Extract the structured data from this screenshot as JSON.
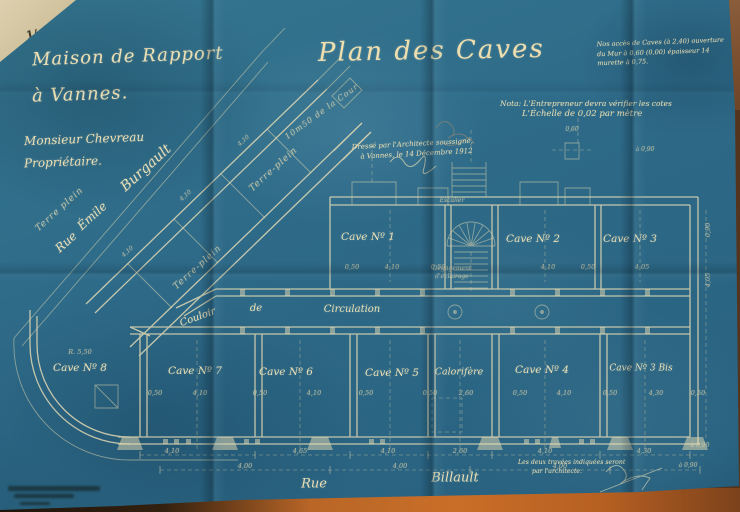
{
  "palette": {
    "paper_blue": "#2e6b89",
    "ink_cream": "#eadfb5",
    "table_orange": "#c96e28",
    "table_cream": "#ddd0ae",
    "table_brown": "#6e4527"
  },
  "header": {
    "corner_mark": "1/",
    "line1": "Maison de Rapport",
    "line2": "à Vannes.",
    "line3": "Monsieur Chevreau",
    "line4": "Propriétaire.",
    "title": "Plan des Caves"
  },
  "notes": {
    "top_right": [
      "Nos accès de Caves (à 2,40) ouverture",
      "du Mur à 0,60 (0,00) épaisseur 14",
      "murette à 0,75."
    ],
    "nota_line1": "Nota: L'Entrepreneur devra vérifier les cotes",
    "nota_line2": "L'Échelle de 0,02 par mètre",
    "architect_line1": "Dressé par l'Architecte soussigné,",
    "architect_line2": "à Vannes, le 14 Décembre 1912",
    "bottom_line1": "Les deux travées indiquées seront",
    "bottom_line2": "par l'architecte."
  },
  "labels": [
    {
      "n": "room-label-cave-1",
      "t": "Cave Nº 1",
      "x": 368,
      "y": 237,
      "s": 10.5
    },
    {
      "n": "room-label-cave-2",
      "t": "Cave Nº 2",
      "x": 533,
      "y": 239,
      "s": 10.5
    },
    {
      "n": "room-label-cave-3",
      "t": "Cave Nº 3",
      "x": 630,
      "y": 239,
      "s": 10.5
    },
    {
      "n": "room-label-cave-8",
      "t": "Cave Nº 8",
      "x": 80,
      "y": 368,
      "s": 10.5
    },
    {
      "n": "room-label-cave-7",
      "t": "Cave Nº 7",
      "x": 195,
      "y": 371,
      "s": 10.5
    },
    {
      "n": "room-label-cave-6",
      "t": "Cave Nº 6",
      "x": 286,
      "y": 372,
      "s": 10.5
    },
    {
      "n": "room-label-cave-5",
      "t": "Cave Nº 5",
      "x": 392,
      "y": 373,
      "s": 10.5
    },
    {
      "n": "room-label-calorifere",
      "t": "Calorifère",
      "x": 459,
      "y": 372,
      "s": 9.5
    },
    {
      "n": "room-label-cave-4",
      "t": "Cave Nº 4",
      "x": 542,
      "y": 370,
      "s": 10.5
    },
    {
      "n": "room-label-cave-3bis",
      "t": "Cave Nº 3 Bis",
      "x": 641,
      "y": 369,
      "s": 9
    },
    {
      "n": "corridor-label-couloir",
      "t": "Couloir",
      "x": 198,
      "y": 318,
      "s": 10,
      "r": -20
    },
    {
      "n": "corridor-label-de",
      "t": "de",
      "x": 256,
      "y": 309,
      "s": 10
    },
    {
      "n": "corridor-label-circulation",
      "t": "Circulation",
      "x": 352,
      "y": 310,
      "s": 10
    },
    {
      "n": "stair-label-degagement",
      "t": "Dégagement",
      "x": 452,
      "y": 269,
      "s": 6,
      "c": "dim"
    },
    {
      "n": "stair-label-eclairage",
      "t": "d'éclairage",
      "x": 452,
      "y": 277,
      "s": 6,
      "c": "dim"
    },
    {
      "n": "stair-label-escalier",
      "t": "Escalier",
      "x": 452,
      "y": 201,
      "s": 6,
      "c": "dim"
    },
    {
      "n": "street-rue-emile-rue",
      "t": "Rue",
      "x": 66,
      "y": 242,
      "s": 12,
      "r": -42
    },
    {
      "n": "street-rue-emile-emile",
      "t": "Émile",
      "x": 92,
      "y": 216,
      "s": 12,
      "r": -42
    },
    {
      "n": "street-rue-emile-burgault",
      "t": "Burgault",
      "x": 146,
      "y": 168,
      "s": 14,
      "r": -42
    },
    {
      "n": "terre-plein-left",
      "t": "Terre plein",
      "x": 60,
      "y": 210,
      "s": 9,
      "r": -42,
      "c": "dim2"
    },
    {
      "n": "terre-plein-mid",
      "t": "Terre-plein",
      "x": 274,
      "y": 170,
      "s": 9,
      "r": -42,
      "c": "dim2"
    },
    {
      "n": "terre-plein-low",
      "t": "Terre-plein",
      "x": 198,
      "y": 268,
      "s": 9,
      "r": -42,
      "c": "dim2"
    },
    {
      "n": "cour-note",
      "t": "10m50 de la Cour",
      "x": 322,
      "y": 112,
      "s": 8,
      "r": -36,
      "c": "dim2"
    },
    {
      "n": "street-rue-billault-rue",
      "t": "Rue",
      "x": 314,
      "y": 484,
      "s": 13
    },
    {
      "n": "street-rue-billault-billault",
      "t": "Billault",
      "x": 455,
      "y": 478,
      "s": 13
    },
    {
      "n": "dim-r550",
      "t": "R. 5,50",
      "x": 80,
      "y": 352,
      "s": 6.5,
      "c": "dim"
    },
    {
      "n": "dim-b1",
      "t": "0,50",
      "x": 155,
      "y": 393,
      "s": 6.5,
      "c": "dim"
    },
    {
      "n": "dim-b2",
      "t": "4,10",
      "x": 200,
      "y": 393,
      "s": 6.5,
      "c": "dim"
    },
    {
      "n": "dim-b3",
      "t": "0,50",
      "x": 260,
      "y": 393,
      "s": 6.5,
      "c": "dim"
    },
    {
      "n": "dim-b4",
      "t": "4,10",
      "x": 314,
      "y": 393,
      "s": 6.5,
      "c": "dim"
    },
    {
      "n": "dim-b5",
      "t": "0,50",
      "x": 366,
      "y": 393,
      "s": 6.5,
      "c": "dim"
    },
    {
      "n": "dim-b6",
      "t": "0,50",
      "x": 430,
      "y": 393,
      "s": 6.5,
      "c": "dim"
    },
    {
      "n": "dim-b7",
      "t": "2,60",
      "x": 466,
      "y": 393,
      "s": 6.5,
      "c": "dim"
    },
    {
      "n": "dim-b8",
      "t": "0,50",
      "x": 520,
      "y": 393,
      "s": 6.5,
      "c": "dim"
    },
    {
      "n": "dim-b9",
      "t": "4,10",
      "x": 564,
      "y": 393,
      "s": 6.5,
      "c": "dim"
    },
    {
      "n": "dim-b10",
      "t": "0,50",
      "x": 610,
      "y": 393,
      "s": 6.5,
      "c": "dim"
    },
    {
      "n": "dim-b11",
      "t": "4,30",
      "x": 656,
      "y": 393,
      "s": 6.5,
      "c": "dim"
    },
    {
      "n": "dim-b12",
      "t": "0,50",
      "x": 698,
      "y": 393,
      "s": 6.5,
      "c": "dim"
    },
    {
      "n": "dim-t1",
      "t": "0,50",
      "x": 352,
      "y": 267,
      "s": 6.5,
      "c": "dim"
    },
    {
      "n": "dim-t2",
      "t": "4,10",
      "x": 392,
      "y": 267,
      "s": 6.5,
      "c": "dim"
    },
    {
      "n": "dim-t3",
      "t": "0,50",
      "x": 438,
      "y": 267,
      "s": 6.5,
      "c": "dim"
    },
    {
      "n": "dim-t4",
      "t": "4,10",
      "x": 548,
      "y": 267,
      "s": 6.5,
      "c": "dim"
    },
    {
      "n": "dim-t5",
      "t": "0,50",
      "x": 588,
      "y": 267,
      "s": 6.5,
      "c": "dim"
    },
    {
      "n": "dim-t6",
      "t": "4,05",
      "x": 642,
      "y": 267,
      "s": 6.5,
      "c": "dim"
    },
    {
      "n": "dim-c1",
      "t": "4,10",
      "x": 172,
      "y": 451,
      "s": 6.5,
      "c": "dim"
    },
    {
      "n": "dim-c2",
      "t": "4,65",
      "x": 300,
      "y": 451,
      "s": 6.5,
      "c": "dim"
    },
    {
      "n": "dim-c3",
      "t": "4,10",
      "x": 388,
      "y": 451,
      "s": 6.5,
      "c": "dim"
    },
    {
      "n": "dim-c4",
      "t": "2,60",
      "x": 460,
      "y": 451,
      "s": 6.5,
      "c": "dim"
    },
    {
      "n": "dim-c5",
      "t": "4,10",
      "x": 545,
      "y": 451,
      "s": 6.5,
      "c": "dim"
    },
    {
      "n": "dim-c6",
      "t": "4,30",
      "x": 644,
      "y": 451,
      "s": 6.5,
      "c": "dim"
    },
    {
      "n": "dim-c7",
      "t": "4,00",
      "x": 245,
      "y": 466,
      "s": 6.5,
      "c": "dim"
    },
    {
      "n": "dim-c8",
      "t": "4,00",
      "x": 400,
      "y": 466,
      "s": 6.5,
      "c": "dim"
    },
    {
      "n": "dim-c9",
      "t": "4,00",
      "x": 560,
      "y": 466,
      "s": 6.5,
      "c": "dim"
    },
    {
      "n": "dim-c10",
      "t": "à 0,90",
      "x": 688,
      "y": 466,
      "s": 6,
      "c": "dim"
    },
    {
      "n": "dim-r1",
      "t": "4,05",
      "x": 708,
      "y": 280,
      "s": 6.5,
      "r": -90,
      "c": "dim"
    },
    {
      "n": "dim-r2",
      "t": "0,90",
      "x": 708,
      "y": 230,
      "s": 6.5,
      "r": -90,
      "c": "dim"
    },
    {
      "n": "dim-m1",
      "t": "à 0,90",
      "x": 700,
      "y": 446,
      "s": 6,
      "c": "dim"
    },
    {
      "n": "dim-m2",
      "t": "à 0,90",
      "x": 645,
      "y": 150,
      "s": 6,
      "c": "dim"
    },
    {
      "n": "dim-m3",
      "t": "0,60",
      "x": 572,
      "y": 130,
      "s": 6,
      "c": "dim"
    },
    {
      "n": "dim-w1",
      "t": "4,10",
      "x": 128,
      "y": 252,
      "s": 6,
      "r": -42,
      "c": "dim"
    },
    {
      "n": "dim-w2",
      "t": "4,10",
      "x": 186,
      "y": 196,
      "s": 6,
      "r": -42,
      "c": "dim"
    },
    {
      "n": "dim-w3",
      "t": "4,10",
      "x": 244,
      "y": 141,
      "s": 6,
      "r": -42,
      "c": "dim"
    }
  ]
}
